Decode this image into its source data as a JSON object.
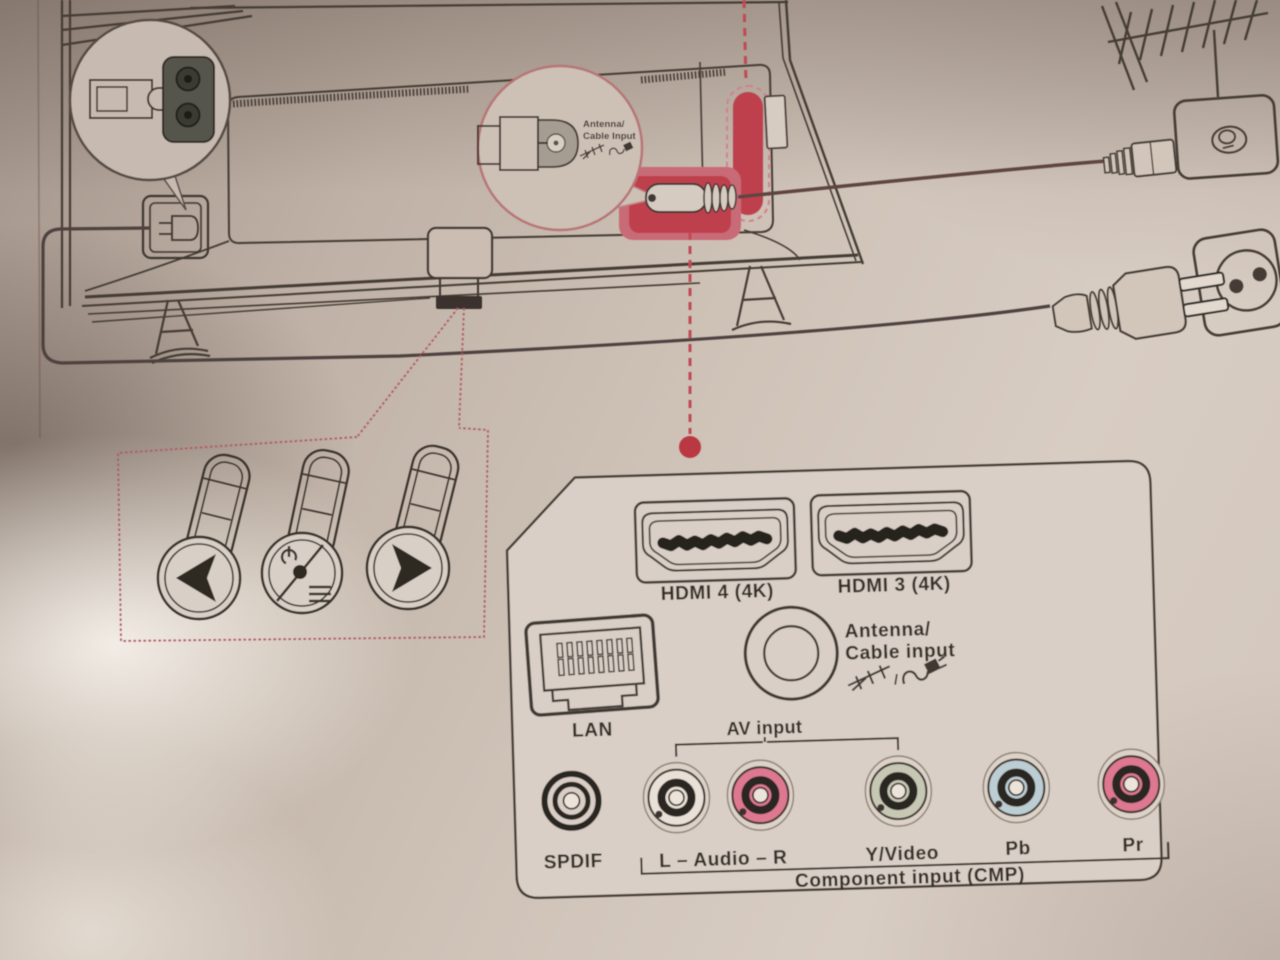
{
  "zoom_callout": {
    "line1": "Antenna/",
    "line2": "Cable Input"
  },
  "ports_panel": {
    "hdmi4": "HDMI 4 (4K)",
    "hdmi3": "HDMI 3 (4K)",
    "lan": "LAN",
    "antenna_line1": "Antenna/",
    "antenna_line2": "Cable input",
    "icon_separator": "/",
    "av_input": "AV input",
    "spdif": "SPDIF",
    "audio": "L – Audio – R",
    "yvideo": "Y/Video",
    "pb": "Pb",
    "pr": "Pr",
    "component": "Component input (CMP)"
  },
  "colors": {
    "accent_red": "#bf3f4d",
    "highlight_pink": "#c96a77",
    "dashed_red": "#b35a62",
    "jack_white": "#e9e1d7",
    "jack_red": "#dd7890",
    "jack_green": "#c6c8b4",
    "jack_blue": "#bccdd3",
    "line": "#3f3831"
  }
}
